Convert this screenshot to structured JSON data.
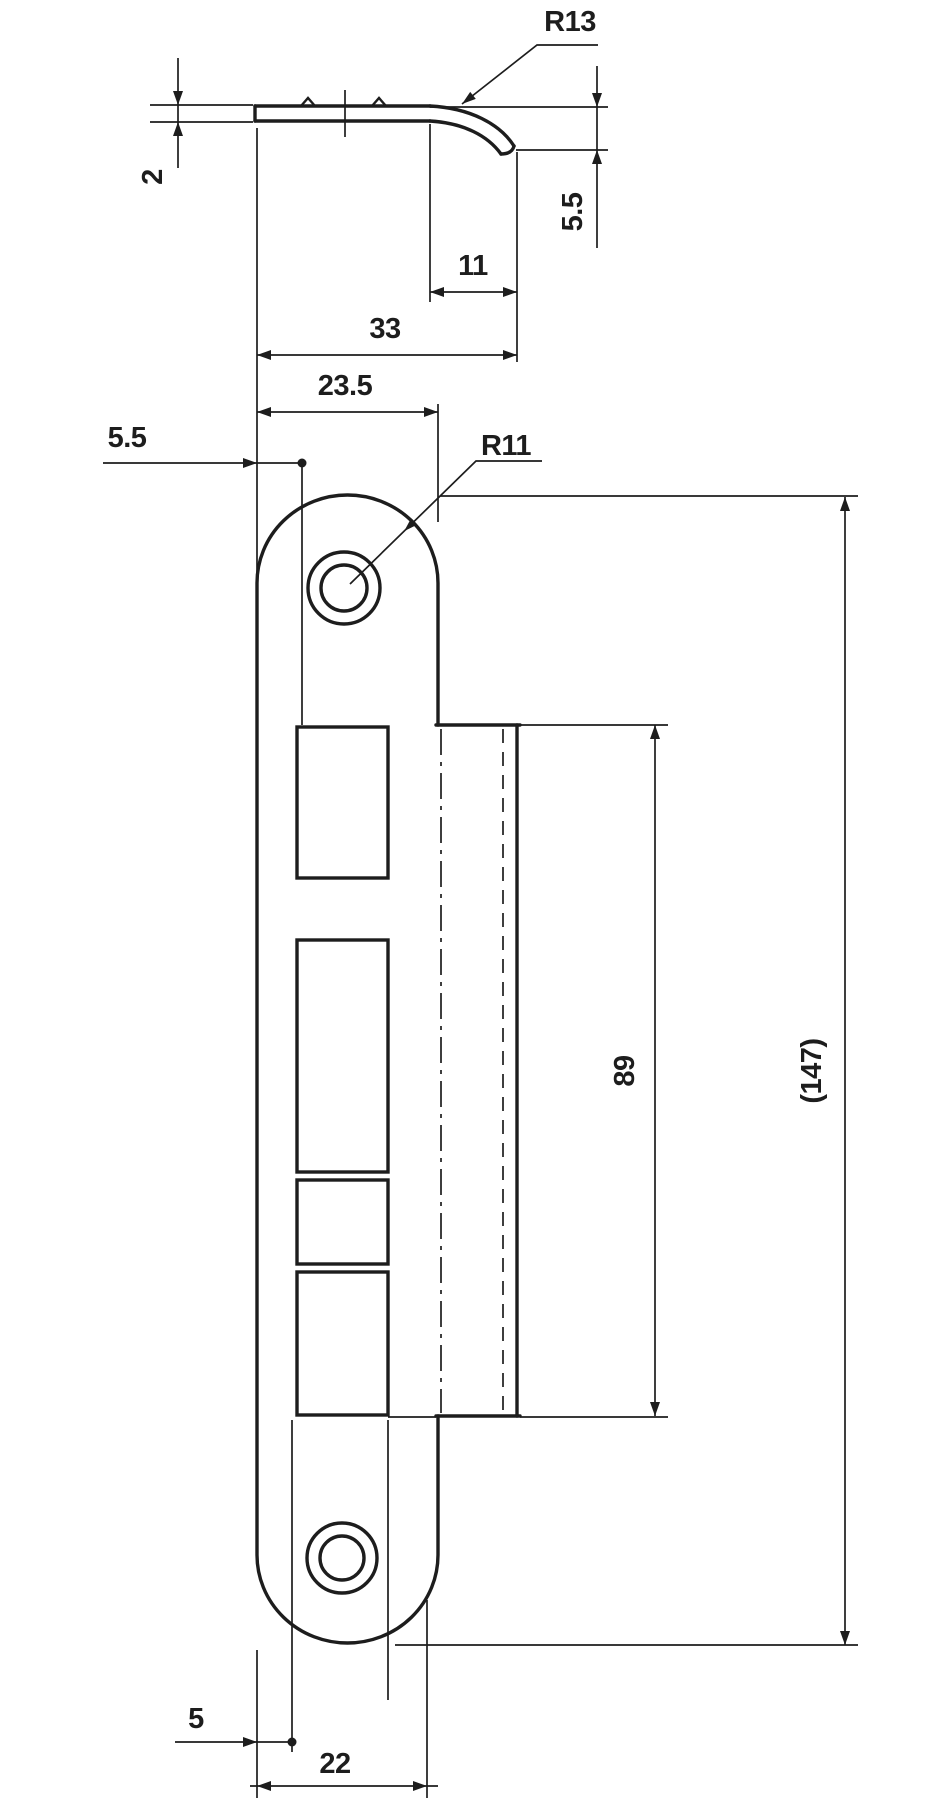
{
  "drawing": {
    "title": "strike-plate-technical-drawing",
    "section_view": {
      "lip_radius_label": "R13",
      "thickness_label": "2",
      "lip_height_label": "5.5",
      "lip_projection_label": "11",
      "overall_depth_label": "33"
    },
    "front_view": {
      "plate_width_label": "23.5",
      "edge_offset_label": "5.5",
      "corner_radius_label": "R11",
      "lip_length_label": "89",
      "overall_length_label": "(147)",
      "bottom_offset_label": "5",
      "bottom_width_label": "22"
    },
    "colors": {
      "line": "#1d1d1d",
      "background": "#ffffff"
    }
  }
}
